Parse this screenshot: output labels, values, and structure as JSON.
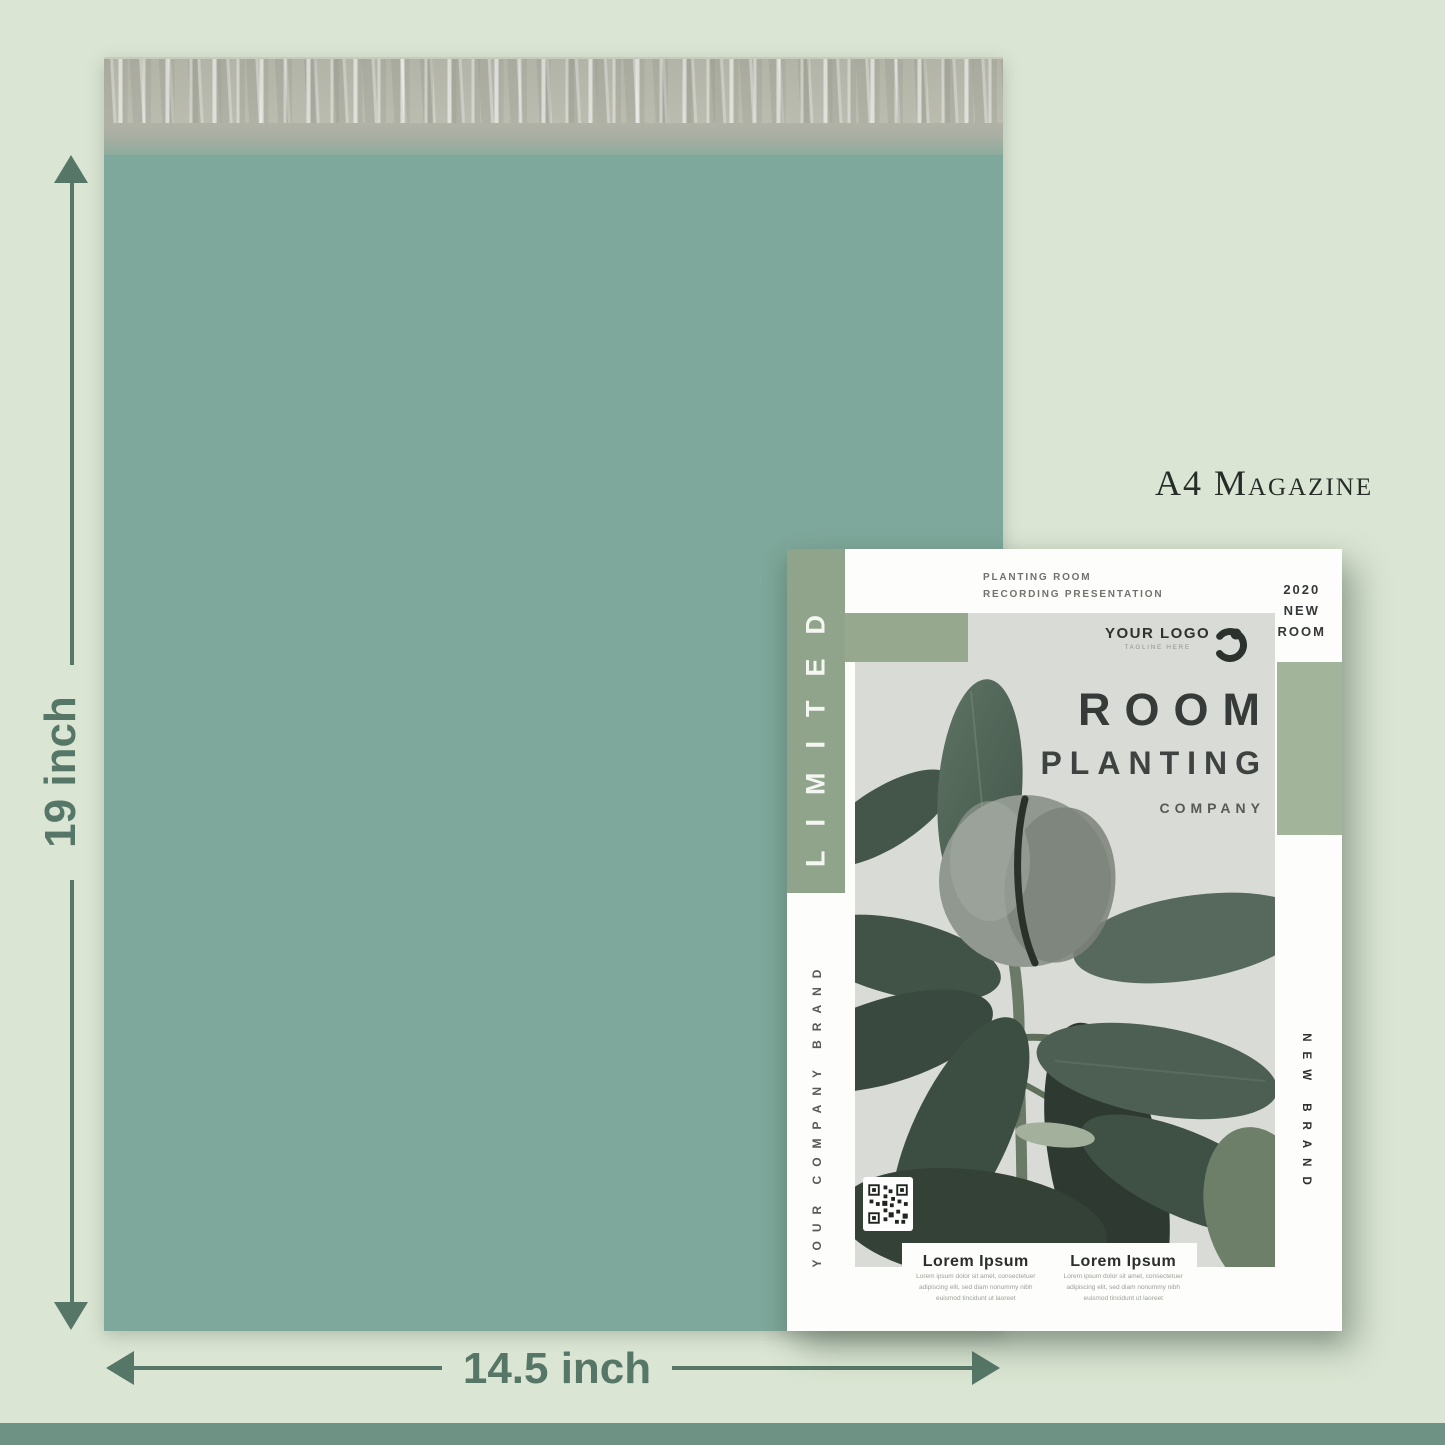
{
  "annotations": {
    "height_label": "19 inch",
    "width_label": "14.5 inch",
    "size_label": "A4 Magazine"
  },
  "magazine": {
    "spine_text": "LIMITED",
    "header": {
      "line1": "PLANTING ROOM",
      "line2": "RECORDING PRESENTATION"
    },
    "issue": {
      "line1": "2020",
      "line2": "NEW",
      "line3": "ROOM"
    },
    "logo": {
      "name": "YOUR LOGO",
      "tagline": "TAGLINE HERE"
    },
    "title": {
      "line1": "ROOM",
      "line2": "PLANTING",
      "line3": "COMPANY"
    },
    "left_margin_text": "YOUR COMPANY BRAND",
    "right_margin_text": "NEW BRAND",
    "columns": [
      {
        "heading": "Lorem Ipsum",
        "lines": [
          "Lorem ipsum dolor sit amet, consectetuer",
          "adipiscing elit, sed diam nonummy nibh",
          "euismod tincidunt ut laoreet"
        ]
      },
      {
        "heading": "Lorem Ipsum",
        "lines": [
          "Lorem ipsum dolor sit amet, consectetuer",
          "adipiscing elit, sed diam nonummy nibh",
          "euismod tincidunt ut laoreet"
        ]
      }
    ]
  },
  "colors": {
    "background": "#dbe5d3",
    "bottom-strip": "#6e9284",
    "mailer-body": "#7ea89b",
    "mailer-flap": "#b6b7ab",
    "dimension": "#567767",
    "band-left": "#8fa48a",
    "band-right": "#a2b59a",
    "band-square": "#96a98e",
    "photo-bg": "#d9dcd6",
    "page": "#fdfdfb",
    "ink": "#363a38"
  }
}
